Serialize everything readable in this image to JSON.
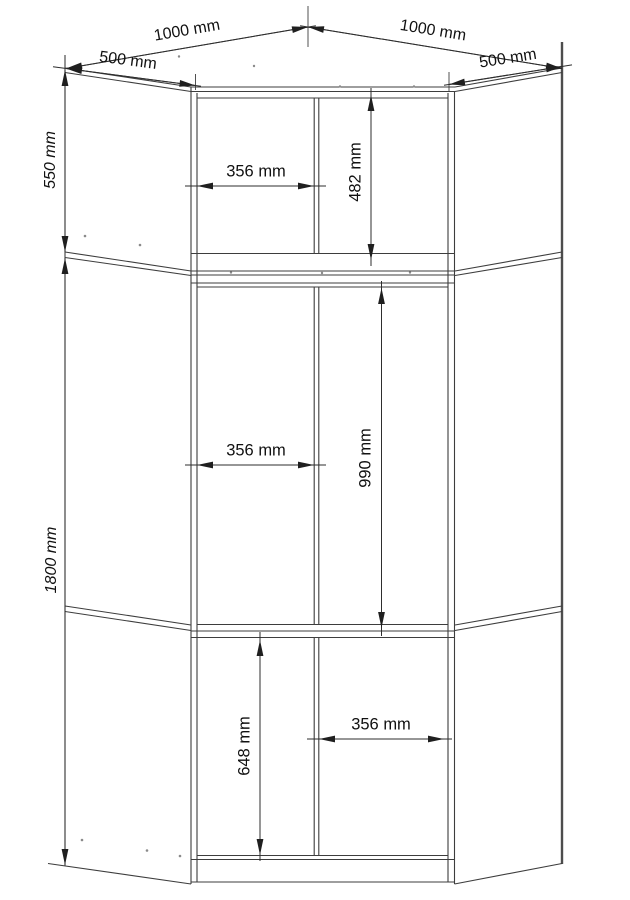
{
  "diagram": {
    "type": "technical-drawing",
    "subject": "corner-wardrobe-front-view",
    "unit": "mm",
    "line_color": "#3d3d3d",
    "background": "#ffffff"
  },
  "dimensions": {
    "top_width_left": "1000 mm",
    "top_width_right": "1000 mm",
    "side_depth_left": "500 mm",
    "side_depth_right": "500 mm",
    "upper_section_height": "550 mm",
    "lower_section_height": "1800 mm",
    "upper_door_width": "356 mm",
    "upper_inner_height": "482 mm",
    "middle_door_width": "356 mm",
    "middle_inner_height": "990 mm",
    "bottom_inner_height": "648 mm",
    "bottom_door_width": "356 mm"
  },
  "labels": [
    {
      "id": "top-width-left",
      "text": "1000 mm",
      "x": 187,
      "y": 31,
      "rot": -9.7,
      "italic": false,
      "big": false
    },
    {
      "id": "top-width-right",
      "text": "1000 mm",
      "x": 433,
      "y": 31,
      "rot": 9.3,
      "italic": false,
      "big": false
    },
    {
      "id": "side-depth-left",
      "text": "500 mm",
      "x": 128,
      "y": 61,
      "rot": 7.4,
      "italic": false,
      "big": false
    },
    {
      "id": "side-depth-right",
      "text": "500 mm",
      "x": 508,
      "y": 59,
      "rot": -9,
      "italic": false,
      "big": false
    },
    {
      "id": "upper-section-height",
      "text": "550 mm",
      "x": 51,
      "y": 160,
      "rot": -90,
      "italic": true,
      "big": false
    },
    {
      "id": "lower-section-height",
      "text": "1800 mm",
      "x": 52,
      "y": 560,
      "rot": -90,
      "italic": true,
      "big": false
    },
    {
      "id": "upper-door-width",
      "text": "356 mm",
      "x": 256,
      "y": 172,
      "rot": 0,
      "italic": false,
      "big": true
    },
    {
      "id": "upper-inner-height",
      "text": "482 mm",
      "x": 356,
      "y": 172,
      "rot": -90,
      "italic": false,
      "big": true
    },
    {
      "id": "middle-door-width",
      "text": "356 mm",
      "x": 256,
      "y": 451,
      "rot": 0,
      "italic": false,
      "big": true
    },
    {
      "id": "middle-inner-height",
      "text": "990 mm",
      "x": 366,
      "y": 458,
      "rot": -90,
      "italic": false,
      "big": true
    },
    {
      "id": "bottom-inner-height",
      "text": "648 mm",
      "x": 245,
      "y": 746,
      "rot": -90,
      "italic": false,
      "big": true
    },
    {
      "id": "bottom-door-width",
      "text": "356 mm",
      "x": 381,
      "y": 725,
      "rot": 0,
      "italic": false,
      "big": true
    }
  ]
}
